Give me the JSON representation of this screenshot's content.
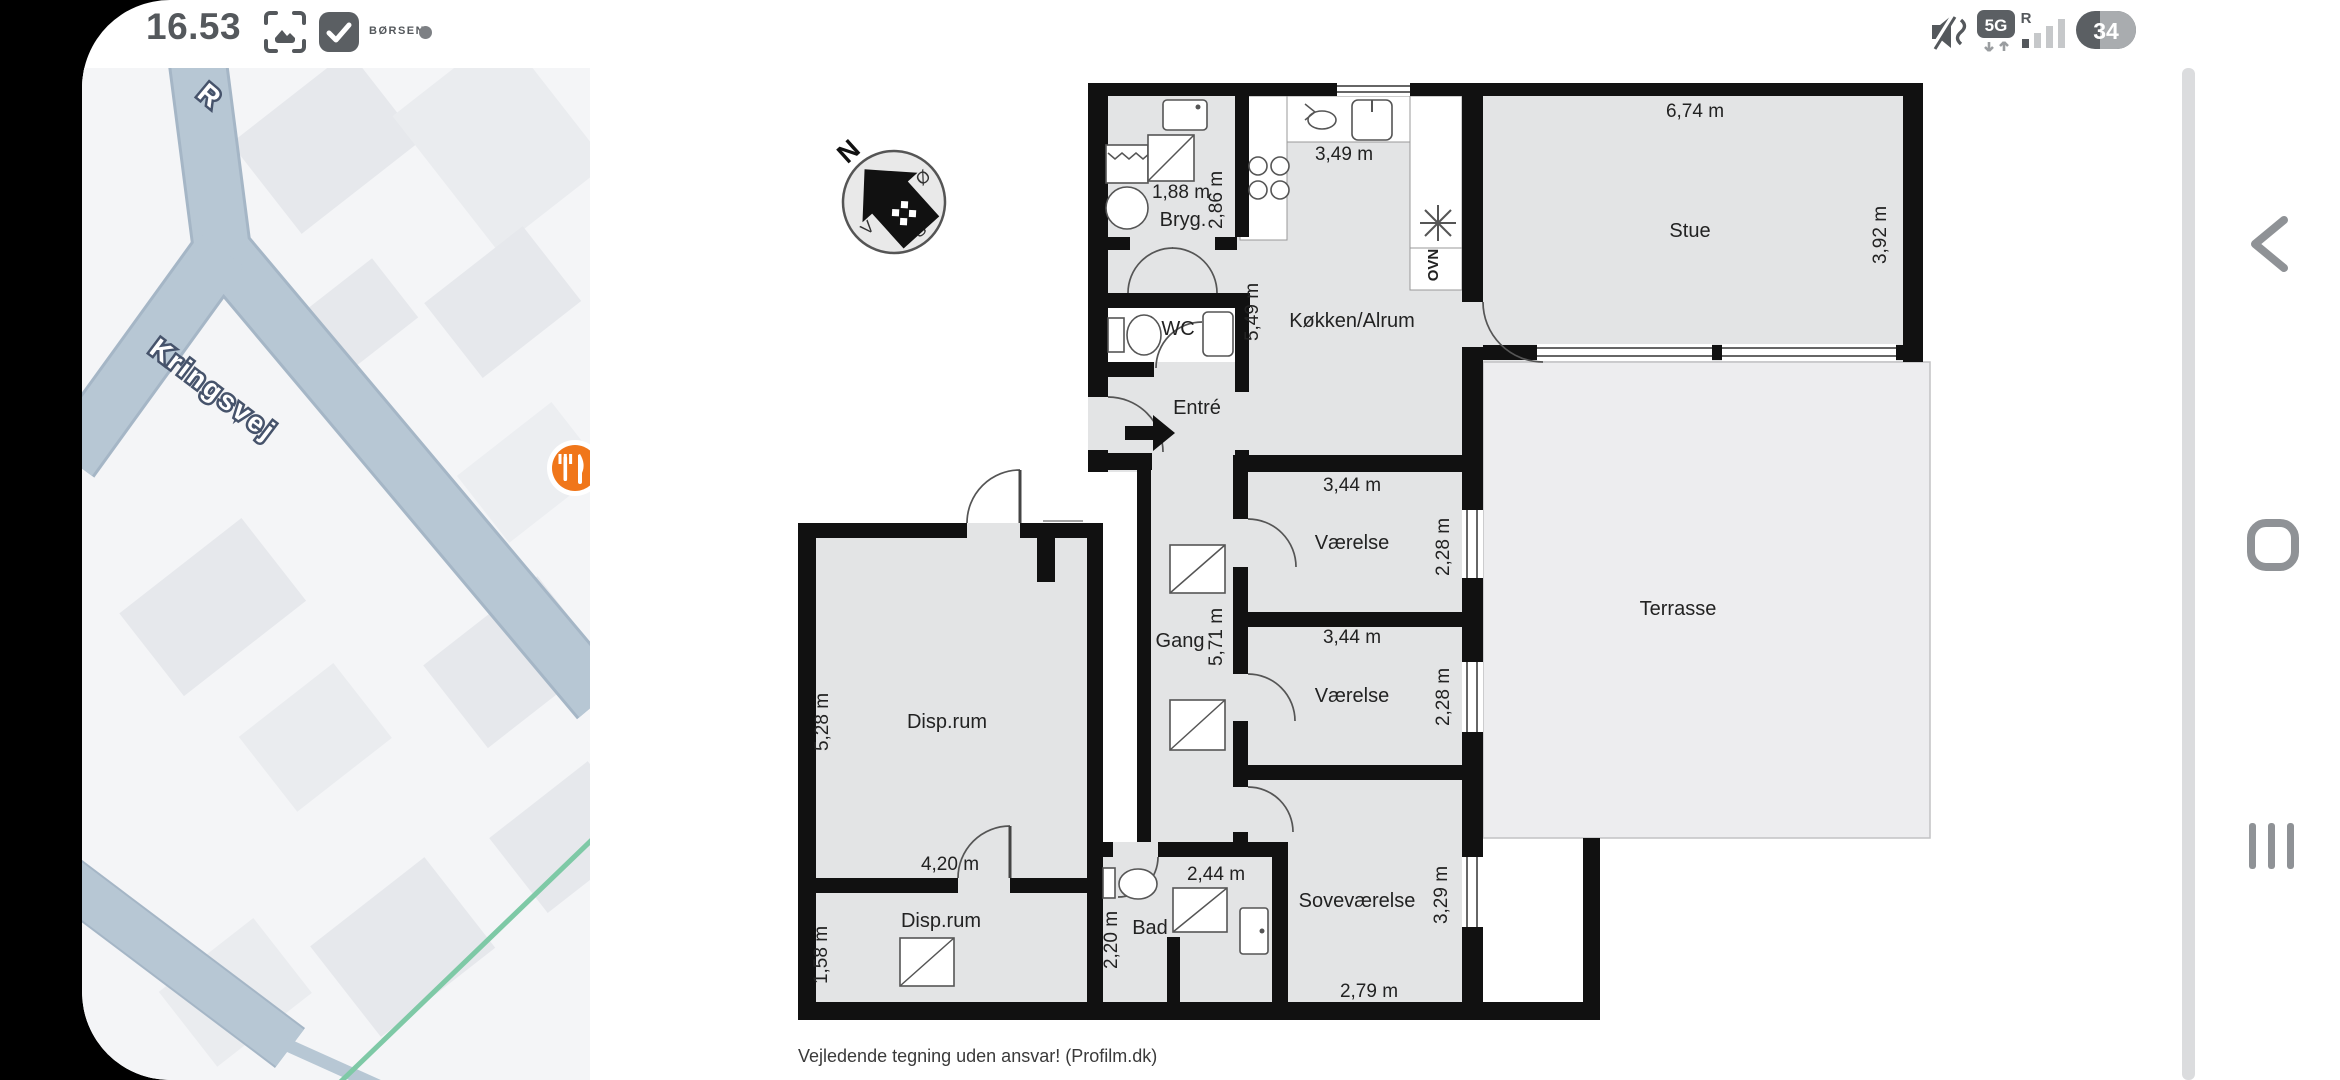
{
  "status_bar": {
    "time": "16.53",
    "notification_source": "BØRSEN",
    "network_badge": "5G",
    "roaming_indicator": "R",
    "battery_percent": "34"
  },
  "map": {
    "street_label": "Kringsvej",
    "street_label_partial": "R",
    "poi_type": "restaurant",
    "colors": {
      "background": "#f4f5f7",
      "road": "#b7c7d4",
      "building": "#e6e8ec",
      "green_path": "#7ec9a6",
      "poi": "#f0761a"
    }
  },
  "floorplan": {
    "compass": {
      "north": "N",
      "east": "Ø",
      "south": "S",
      "west": "V"
    },
    "rooms": [
      {
        "name": "Bryg.",
        "width": "1,88 m",
        "depth": "2,86 m"
      },
      {
        "name": "WC"
      },
      {
        "name": "Entré"
      },
      {
        "name": "Køkken/Alrum",
        "width": "3,49 m",
        "depth": "5,49 m"
      },
      {
        "name": "Stue",
        "width": "6,74 m",
        "depth": "3,92 m"
      },
      {
        "name": "Værelse",
        "width": "3,44 m",
        "depth": "2,28 m"
      },
      {
        "name": "Værelse",
        "width": "3,44 m",
        "depth": "2,28 m"
      },
      {
        "name": "Gang",
        "depth": "5,71 m"
      },
      {
        "name": "Terrasse"
      },
      {
        "name": "Disp.rum",
        "width": "4,20 m",
        "depth": "5,28 m"
      },
      {
        "name": "Disp.rum",
        "depth": "1,58 m"
      },
      {
        "name": "Bad",
        "width": "2,44 m",
        "depth": "2,20 m"
      },
      {
        "name": "Soveværelse",
        "width": "2,79 m",
        "depth": "3,29 m"
      }
    ],
    "appliance_label": "OVN",
    "disclaimer": "Vejledende tegning uden ansvar! (Profilm.dk)"
  },
  "nav_bar": {
    "back": "back",
    "home": "home",
    "recents": "recents"
  }
}
